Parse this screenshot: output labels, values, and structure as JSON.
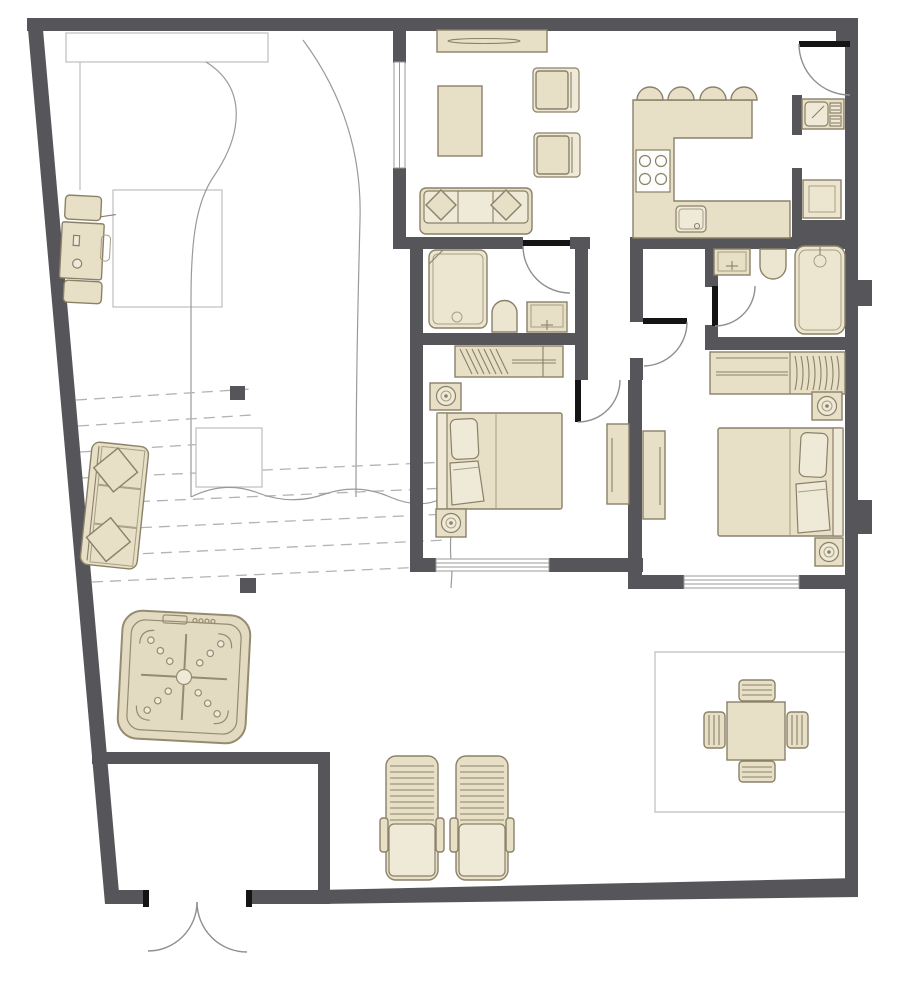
{
  "palette": {
    "wall": "#56565a",
    "floor": "#ffffff",
    "furniture_fill": "#e7dfc6",
    "furniture_fill_light": "#efe9d8",
    "fixture_fill": "#ece5d0",
    "hot_tub_fill": "#e3dac2",
    "furniture_stroke": "#8a8168",
    "hot_tub_stroke": "#958c6f",
    "door_leaf": "#141414",
    "door_arc": "#8f8f8f",
    "window_line": "#9a9a9a",
    "outline_thin": "#bdbdbd",
    "dash_line": "#b3b3b3"
  },
  "plan": {
    "type": "apartment-floor-plan-with-terrace",
    "rooms": [
      {
        "name": "living-room",
        "items": [
          "sideboard",
          "coffee-table",
          "armchair",
          "armchair",
          "sofa-with-cushions"
        ]
      },
      {
        "name": "kitchen",
        "items": [
          "u-shaped-counter",
          "bar-stool",
          "bar-stool",
          "bar-stool",
          "bar-stool",
          "cooktop-4-burner",
          "kitchen-sink"
        ]
      },
      {
        "name": "entry",
        "items": [
          "entry-door"
        ]
      },
      {
        "name": "utility-niche",
        "items": [
          "utility-sink",
          "washer"
        ]
      },
      {
        "name": "bathroom-1",
        "items": [
          "shower-tub",
          "toilet",
          "vanity-sink",
          "door"
        ]
      },
      {
        "name": "bathroom-2",
        "items": [
          "vanity-sink",
          "toilet",
          "bathtub-with-shower",
          "door"
        ]
      },
      {
        "name": "bedroom-1",
        "items": [
          "wardrobe-with-hangers",
          "double-bed",
          "nightstand-with-lamp",
          "nightstand-with-lamp",
          "dresser",
          "window",
          "door"
        ]
      },
      {
        "name": "bedroom-2",
        "items": [
          "wardrobe-with-hangers",
          "double-bed",
          "nightstand-with-lamp",
          "nightstand-with-lamp",
          "dresser",
          "window",
          "door"
        ]
      },
      {
        "name": "terrace",
        "items": [
          "bbq-grill",
          "outdoor-sofa-with-pillows",
          "steps-dashed",
          "stair-landing",
          "hot-tub-with-jets",
          "sun-lounger",
          "sun-lounger",
          "outdoor-dining-table",
          "outdoor-chair",
          "outdoor-chair",
          "outdoor-chair",
          "outdoor-chair",
          "storage-room",
          "double-entry-doors",
          "curved-path"
        ]
      }
    ]
  }
}
